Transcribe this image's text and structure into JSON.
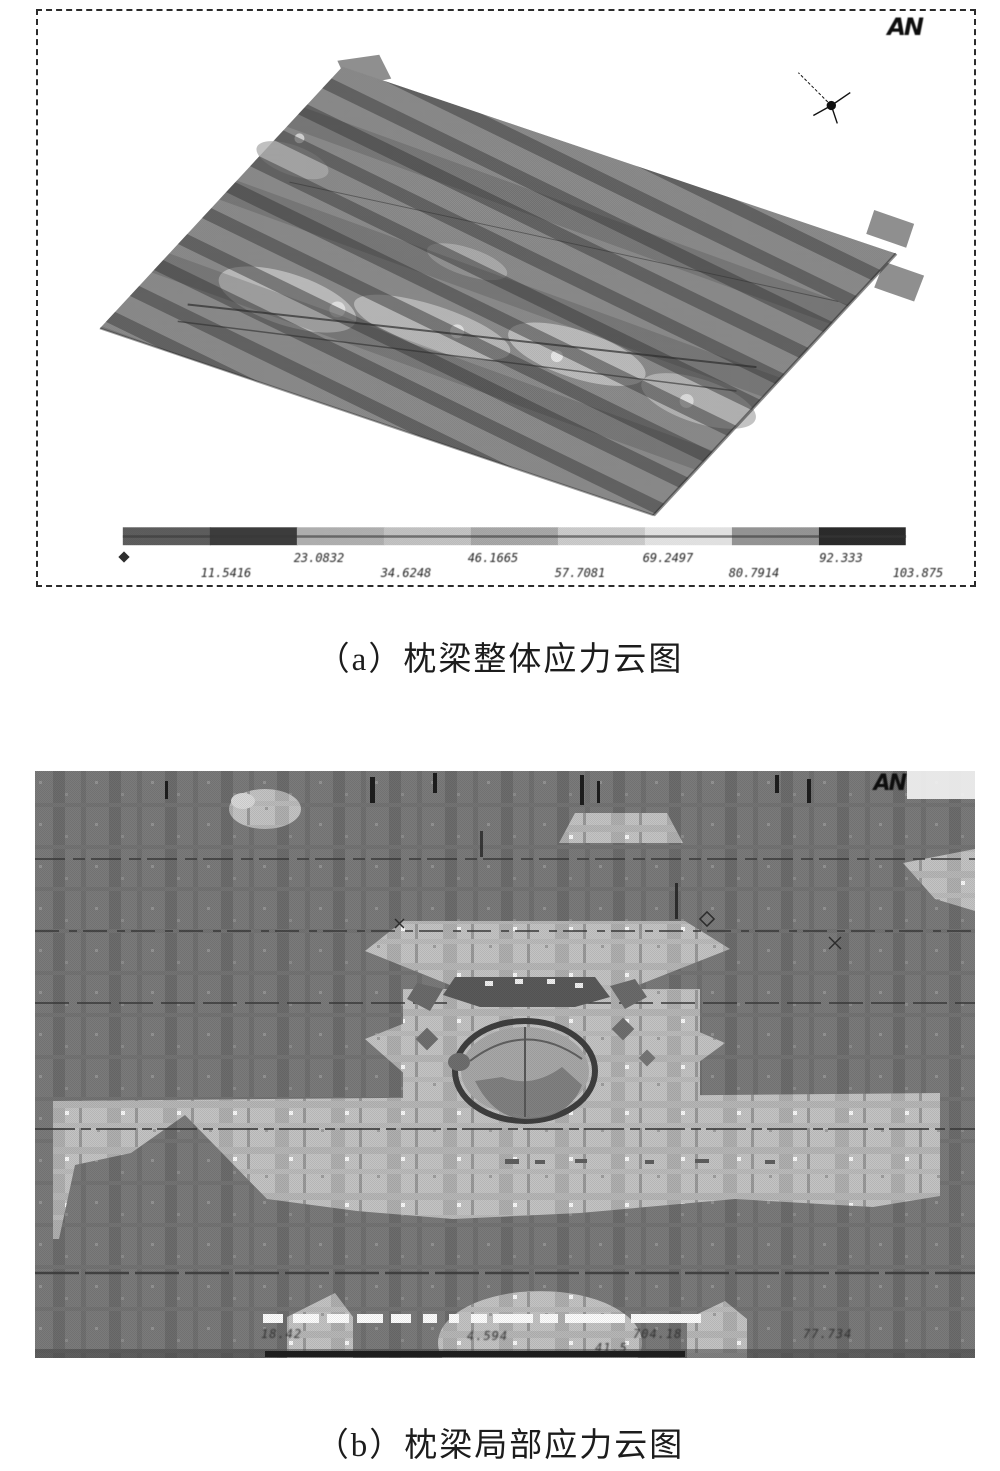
{
  "figure_a": {
    "title_semantic": "overall stress contour of sleeper beam (ANSYS plot)",
    "logo_text": "AN",
    "caption": "（a）枕梁整体应力云图",
    "legend": {
      "min_label": "0",
      "upper_row_labels": [
        "23.0832",
        "46.1665",
        "69.2497",
        "92.333"
      ],
      "lower_row_labels": [
        "11.5416",
        "34.6248",
        "57.7081",
        "80.7914",
        "103.875"
      ],
      "range_min": 0,
      "range_max": 103.875,
      "segment_colors": [
        "#616161",
        "#3f3f3f",
        "#b7b7b7",
        "#cacaca",
        "#aeaeae",
        "#d3d3d3",
        "#ececec",
        "#9b9b9b",
        "#2d2d2d"
      ]
    },
    "colors": {
      "plate_base": "#8f8f8f",
      "stripe_dark": "#3c3c3c",
      "highlight_band": "#c7c7c7",
      "frame_border": "#2b2b2b",
      "background": "#ffffff"
    }
  },
  "figure_b": {
    "title_semantic": "local stress contour of sleeper beam around pivot hole (ANSYS plot)",
    "logo_text": "AN",
    "caption": "（b）枕梁局部应力云图",
    "legend_fragments": [
      "18.42",
      "4.594",
      "41.5",
      "704.18",
      "77.734"
    ],
    "colors": {
      "background_gray": "#7b7b7b",
      "light_band": "#c4c4c4",
      "ring_dark": "#3f3f3f",
      "white_marks": "#fdfdfd"
    }
  }
}
